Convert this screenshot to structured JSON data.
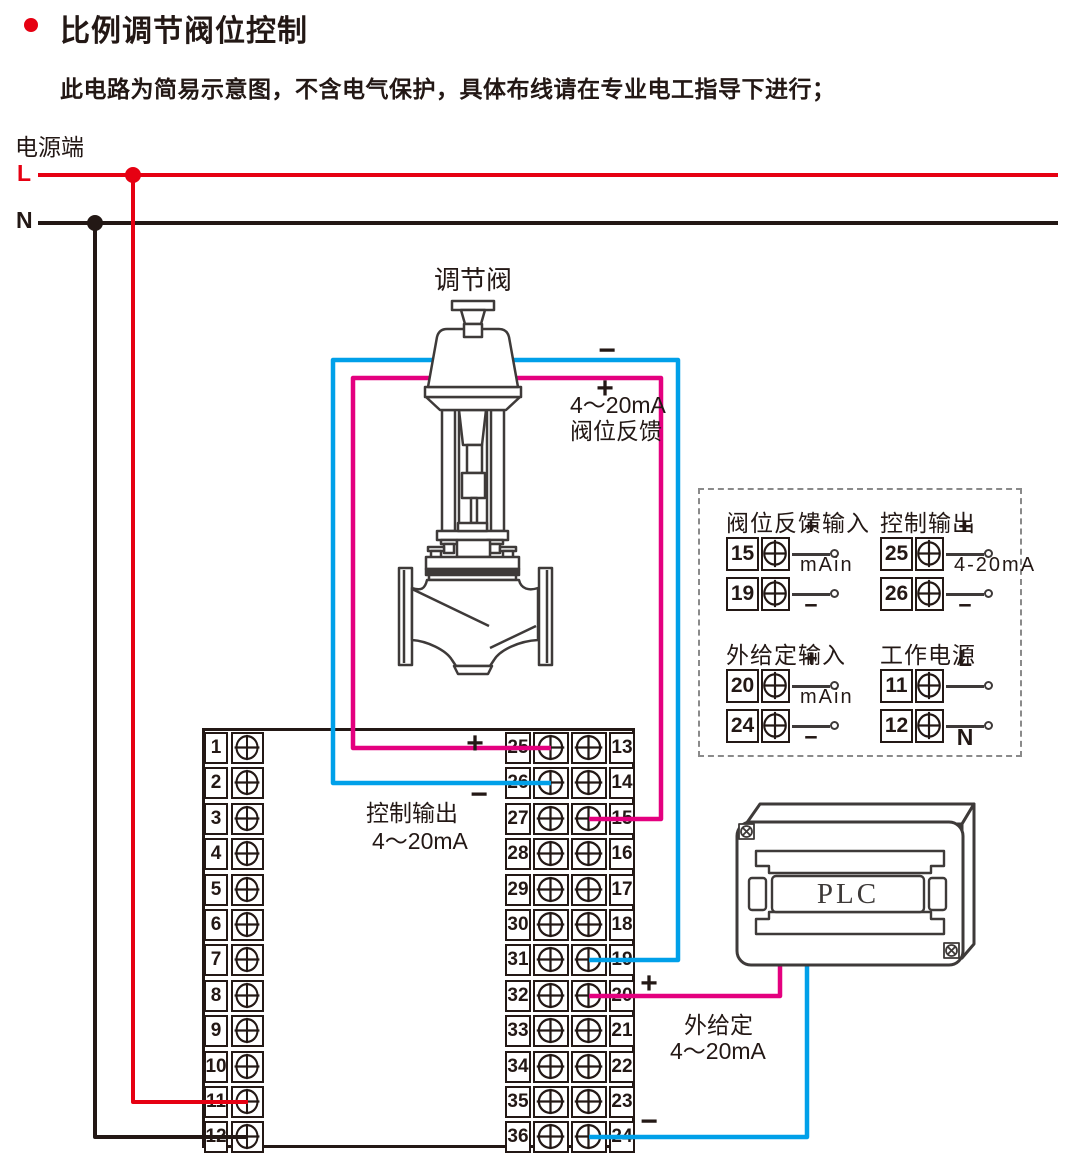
{
  "colors": {
    "red": "#e60012",
    "black": "#231815",
    "cyan": "#00a0e9",
    "magenta": "#e4007f",
    "line": "#3e3a39",
    "dash": "#8a8a8a"
  },
  "header": {
    "title": "比例调节阀位控制",
    "subtitle": "此电路为简易示意图，不含电气保护，具体布线请在专业电工指导下进行；"
  },
  "power": {
    "label": "电源端",
    "live": "L",
    "neutral": "N"
  },
  "valve": {
    "label": "调节阀",
    "minus": "−",
    "plus": "+",
    "feedback_line1": "4～20mA",
    "feedback_line2": "阀位反馈"
  },
  "control_output": {
    "plus": "+",
    "minus": "−",
    "line1": "控制输出",
    "line2": "4～20mA"
  },
  "setpoint": {
    "plus": "+",
    "minus": "−",
    "line1": "外给定",
    "line2": "4～20mA"
  },
  "plc": {
    "label": "PLC"
  },
  "terminals": {
    "left": [
      "1",
      "2",
      "3",
      "4",
      "5",
      "6",
      "7",
      "8",
      "9",
      "10",
      "11",
      "12"
    ],
    "right": [
      {
        "left": "25",
        "right": "13"
      },
      {
        "left": "26",
        "right": "14"
      },
      {
        "left": "27",
        "right": "15"
      },
      {
        "left": "28",
        "right": "16"
      },
      {
        "left": "29",
        "right": "17"
      },
      {
        "left": "30",
        "right": "18"
      },
      {
        "left": "31",
        "right": "19"
      },
      {
        "left": "32",
        "right": "20"
      },
      {
        "left": "33",
        "right": "21"
      },
      {
        "left": "34",
        "right": "22"
      },
      {
        "left": "35",
        "right": "23"
      },
      {
        "left": "36",
        "right": "24"
      }
    ]
  },
  "io_panel": {
    "groups": [
      {
        "title": "阀位反馈输入",
        "mid": "mAin",
        "rows": [
          {
            "num": "15",
            "sign": "+"
          },
          {
            "num": "19",
            "sign": "−"
          }
        ]
      },
      {
        "title": "控制输出",
        "mid": "4-20mA",
        "rows": [
          {
            "num": "25",
            "sign": "+"
          },
          {
            "num": "26",
            "sign": "−"
          }
        ]
      },
      {
        "title": "外给定输入",
        "mid": "mAin",
        "rows": [
          {
            "num": "20",
            "sign": "+"
          },
          {
            "num": "24",
            "sign": "−"
          }
        ]
      },
      {
        "title": "工作电源",
        "mid": "",
        "rows": [
          {
            "num": "11",
            "sign": "L"
          },
          {
            "num": "12",
            "sign": "N"
          }
        ]
      }
    ]
  }
}
